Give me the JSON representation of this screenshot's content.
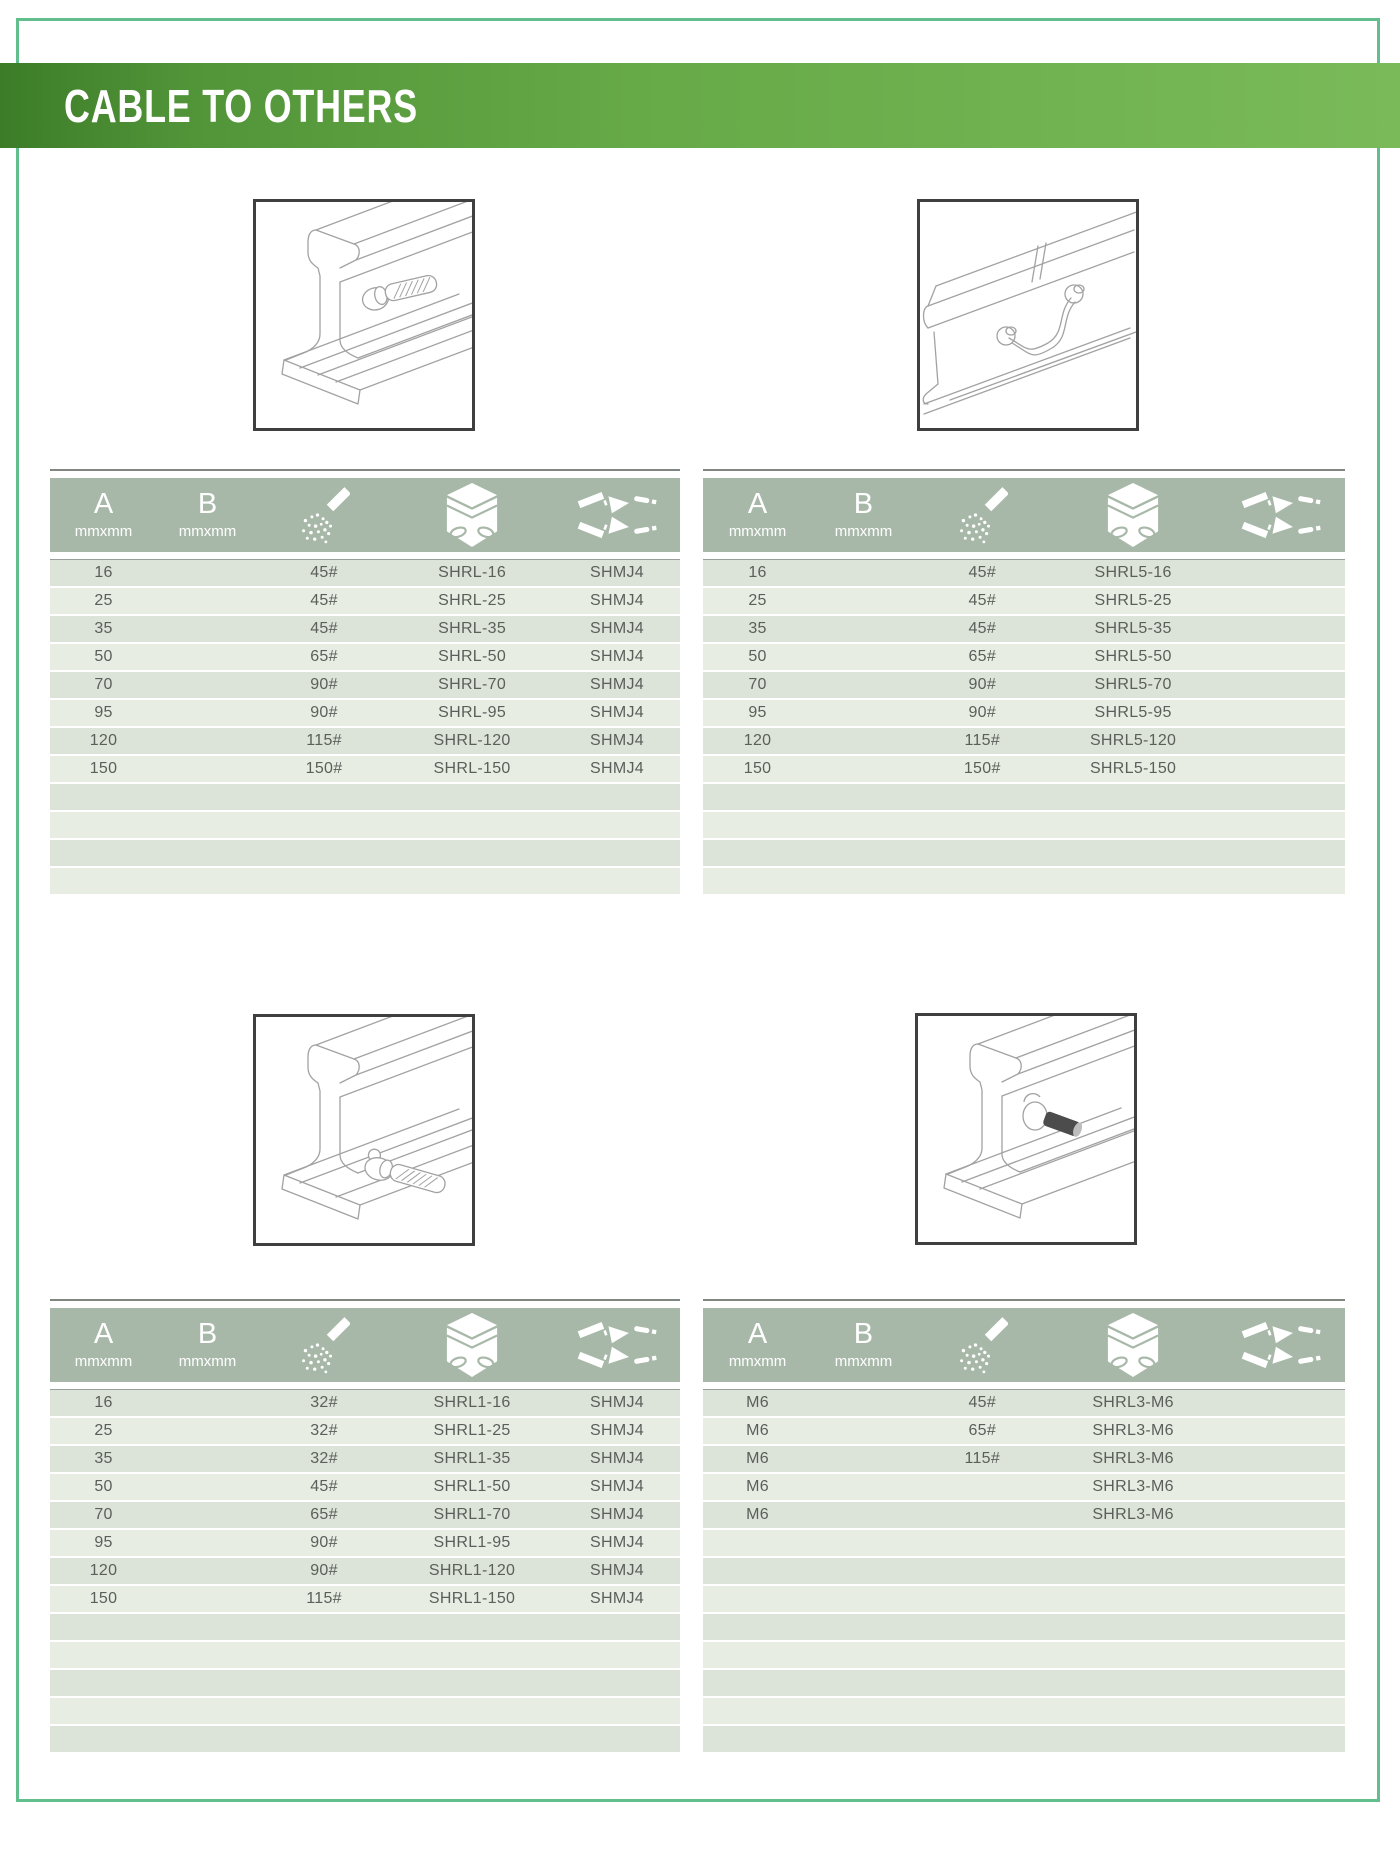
{
  "page": {
    "title": "CABLE TO OTHERS"
  },
  "colors": {
    "banner_green_dark": "#3c7c28",
    "banner_green_light": "#7aba59",
    "frame_green": "#62bf8d",
    "header_sage": "#a7b8a8",
    "row_dark": "#dce3d8",
    "row_light": "#e8ede4",
    "illustration_border": "#3f3f3f"
  },
  "table_header": {
    "col_a_label": "A",
    "col_a_unit": "mmxmm",
    "col_b_label": "B",
    "col_b_unit": "mmxmm",
    "col_powder_icon": "welding-powder-icon",
    "col_mold_icon": "graphite-mold-icon",
    "col_joint_icon": "cable-joint-icon"
  },
  "sections": [
    {
      "illustration": "cable-to-rail-web",
      "rows": [
        {
          "a": "16",
          "b": "",
          "powder": "45#",
          "mold": "SHRL-16",
          "joint": "SHMJ4"
        },
        {
          "a": "25",
          "b": "",
          "powder": "45#",
          "mold": "SHRL-25",
          "joint": "SHMJ4"
        },
        {
          "a": "35",
          "b": "",
          "powder": "45#",
          "mold": "SHRL-35",
          "joint": "SHMJ4"
        },
        {
          "a": "50",
          "b": "",
          "powder": "65#",
          "mold": "SHRL-50",
          "joint": "SHMJ4"
        },
        {
          "a": "70",
          "b": "",
          "powder": "90#",
          "mold": "SHRL-70",
          "joint": "SHMJ4"
        },
        {
          "a": "95",
          "b": "",
          "powder": "90#",
          "mold": "SHRL-95",
          "joint": "SHMJ4"
        },
        {
          "a": "120",
          "b": "",
          "powder": "115#",
          "mold": "SHRL-120",
          "joint": "SHMJ4"
        },
        {
          "a": "150",
          "b": "",
          "powder": "150#",
          "mold": "SHRL-150",
          "joint": "SHMJ4"
        }
      ]
    },
    {
      "illustration": "cable-bond-across-rail-joint",
      "rows": [
        {
          "a": "16",
          "b": "",
          "powder": "45#",
          "mold": "SHRL5-16",
          "joint": ""
        },
        {
          "a": "25",
          "b": "",
          "powder": "45#",
          "mold": "SHRL5-25",
          "joint": ""
        },
        {
          "a": "35",
          "b": "",
          "powder": "45#",
          "mold": "SHRL5-35",
          "joint": ""
        },
        {
          "a": "50",
          "b": "",
          "powder": "65#",
          "mold": "SHRL5-50",
          "joint": ""
        },
        {
          "a": "70",
          "b": "",
          "powder": "90#",
          "mold": "SHRL5-70",
          "joint": ""
        },
        {
          "a": "95",
          "b": "",
          "powder": "90#",
          "mold": "SHRL5-95",
          "joint": ""
        },
        {
          "a": "120",
          "b": "",
          "powder": "115#",
          "mold": "SHRL5-120",
          "joint": ""
        },
        {
          "a": "150",
          "b": "",
          "powder": "150#",
          "mold": "SHRL5-150",
          "joint": ""
        }
      ]
    },
    {
      "illustration": "cable-to-rail-foot",
      "rows": [
        {
          "a": "16",
          "b": "",
          "powder": "32#",
          "mold": "SHRL1-16",
          "joint": "SHMJ4"
        },
        {
          "a": "25",
          "b": "",
          "powder": "32#",
          "mold": "SHRL1-25",
          "joint": "SHMJ4"
        },
        {
          "a": "35",
          "b": "",
          "powder": "32#",
          "mold": "SHRL1-35",
          "joint": "SHMJ4"
        },
        {
          "a": "50",
          "b": "",
          "powder": "45#",
          "mold": "SHRL1-50",
          "joint": "SHMJ4"
        },
        {
          "a": "70",
          "b": "",
          "powder": "65#",
          "mold": "SHRL1-70",
          "joint": "SHMJ4"
        },
        {
          "a": "95",
          "b": "",
          "powder": "90#",
          "mold": "SHRL1-95",
          "joint": "SHMJ4"
        },
        {
          "a": "120",
          "b": "",
          "powder": "90#",
          "mold": "SHRL1-120",
          "joint": "SHMJ4"
        },
        {
          "a": "150",
          "b": "",
          "powder": "115#",
          "mold": "SHRL1-150",
          "joint": "SHMJ4"
        }
      ]
    },
    {
      "illustration": "stud-to-rail-web",
      "rows": [
        {
          "a": "M6",
          "b": "",
          "powder": "45#",
          "mold": "SHRL3-M6",
          "joint": ""
        },
        {
          "a": "M6",
          "b": "",
          "powder": "65#",
          "mold": "SHRL3-M6",
          "joint": ""
        },
        {
          "a": "M6",
          "b": "",
          "powder": "115#",
          "mold": "SHRL3-M6",
          "joint": ""
        },
        {
          "a": "M6",
          "b": "",
          "powder": "",
          "mold": "SHRL3-M6",
          "joint": ""
        },
        {
          "a": "M6",
          "b": "",
          "powder": "",
          "mold": "SHRL3-M6",
          "joint": ""
        }
      ]
    }
  ]
}
